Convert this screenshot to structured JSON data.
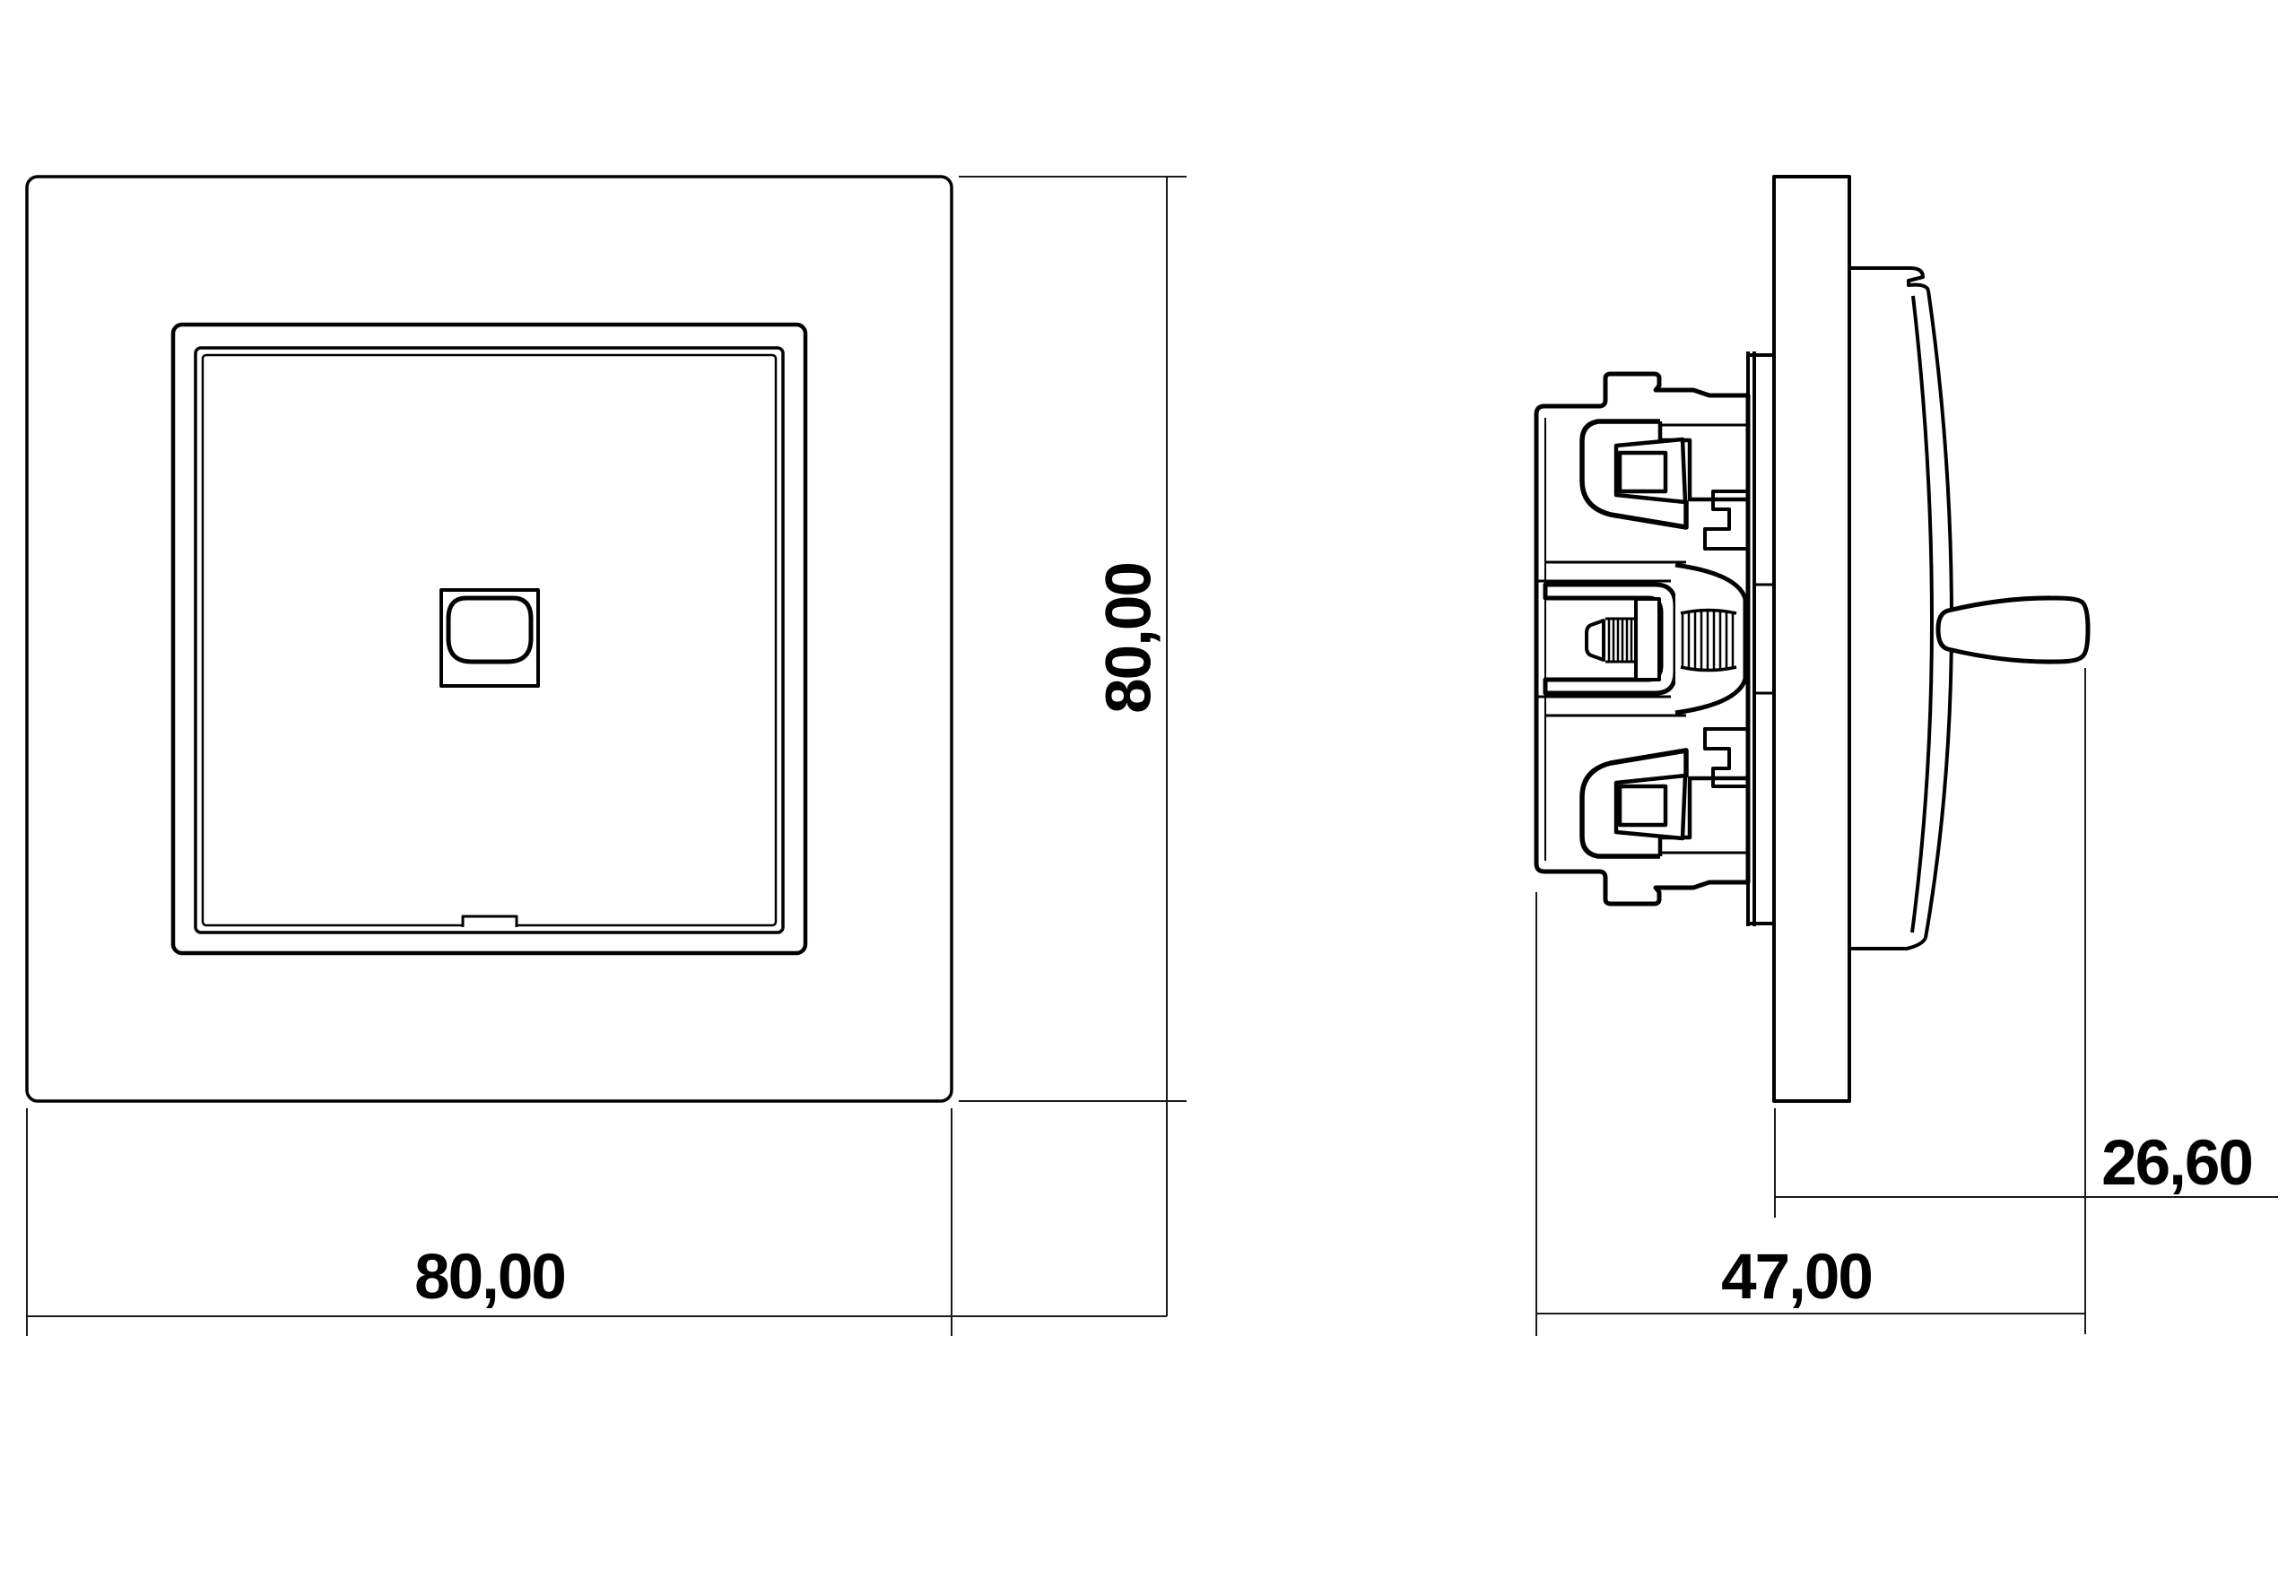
{
  "drawing": {
    "title": "wall-switch-technical-drawing",
    "background_color": "#ffffff",
    "line_color": "#000000",
    "dimension_line_color": "#1a1a1a",
    "views": [
      {
        "name": "front-view",
        "description": "front face of switch with frame, rocker and center button"
      },
      {
        "name": "side-view",
        "description": "side cross-section with mounting claws, screws, frame plate and toggle lever"
      }
    ]
  },
  "dimensions": {
    "front_width": {
      "value": "80,00",
      "unit": "mm",
      "orientation": "horizontal"
    },
    "front_height": {
      "value": "80,00",
      "unit": "mm",
      "orientation": "vertical"
    },
    "side_protrusion": {
      "value": "26,60",
      "unit": "mm",
      "orientation": "horizontal"
    },
    "side_total_depth": {
      "value": "47,00",
      "unit": "mm",
      "orientation": "horizontal"
    }
  }
}
